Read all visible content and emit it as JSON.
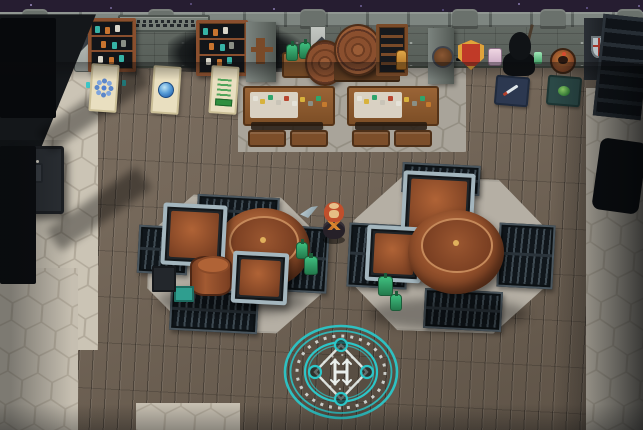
{
  "scene": {
    "kind": "pixel-art game room",
    "setting": "stone-walled tavern brewery interior, night sky visible above wall",
    "player": "red-hooded character standing in center",
    "npc": "dark hooded figure against top-right wall",
    "wall_sign": {
      "legible": false
    }
  },
  "palette": {
    "sky": "#261d31",
    "wood": "#75685a",
    "hex-light": "#cbc4b5",
    "hex-gray": "#a9a49a",
    "cyan": "#2cc6c8",
    "rune-white": "#e9efec",
    "shield-red": "#c03a28",
    "shield-gold": "#dfa43b",
    "rug": "#e9dfc0",
    "mat-navy": "#2c3850",
    "mat-teal": "#2b4947",
    "hood-red": "#c14f2c",
    "tan": "#e5bd85",
    "copper": "#a2552f",
    "steel": "#a4b6be",
    "green": "#2fa56c"
  },
  "icons": {
    "rug_left": "blue-snowflake",
    "rug_middle": "blue-gem",
    "rug_right": "green-scroll",
    "mat_left": "sword",
    "mat_right": "green-orb",
    "wall_crest": "red-gold-shield",
    "floor_item": "gray-dagger",
    "magic_circle": "cyan-teleport-rune-circle"
  },
  "objects": [
    "bookshelf x2",
    "wall-sign",
    "burnt-wall-patch",
    "hanging-banner x3",
    "keg-barrel x3",
    "potion-table",
    "loom-chair",
    "banquet-table x2 with benches",
    "brewing-station x2 (copper vats, framed crates, green bottles)",
    "floor-grate x8",
    "display-rug x3",
    "display-mat x2",
    "hooded-npc",
    "player-character",
    "teleport-circle",
    "stairs-top-right",
    "shadow-furnace-left",
    "dark-cabinet-left"
  ]
}
